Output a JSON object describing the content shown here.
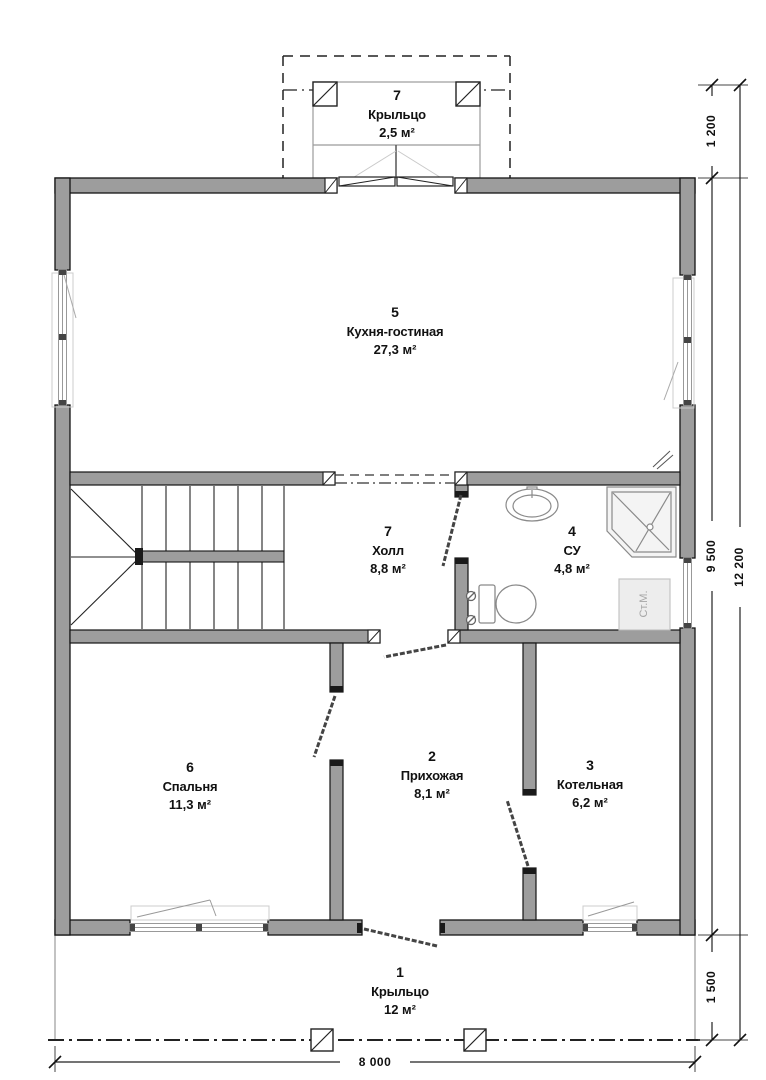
{
  "rooms": {
    "top_porch": {
      "number": "7",
      "name": "Крыльцо",
      "area": "2,5 м²"
    },
    "kitchen_living": {
      "number": "5",
      "name": "Кухня-гостиная",
      "area": "27,3 м²"
    },
    "hall": {
      "number": "7",
      "name": "Холл",
      "area": "8,8 м²"
    },
    "bathroom": {
      "number": "4",
      "name": "СУ",
      "area": "4,8 м²"
    },
    "bedroom": {
      "number": "6",
      "name": "Спальня",
      "area": "11,3 м²"
    },
    "entry": {
      "number": "2",
      "name": "Прихожая",
      "area": "8,1 м²"
    },
    "boiler": {
      "number": "3",
      "name": "Котельная",
      "area": "6,2 м²"
    },
    "porch": {
      "number": "1",
      "name": "Крыльцо",
      "area": "12 м²"
    }
  },
  "dimensions": {
    "porch_depth": "1 200",
    "house_depth": "9 500",
    "terrace_depth": "1 500",
    "total_depth": "12 200",
    "width": "8 000"
  },
  "labels": {
    "washing_machine": "Ст.М."
  },
  "colors": {
    "wall_fill": "#9d9d9d",
    "line": "#141414",
    "fixture": "#8a8a8a"
  }
}
